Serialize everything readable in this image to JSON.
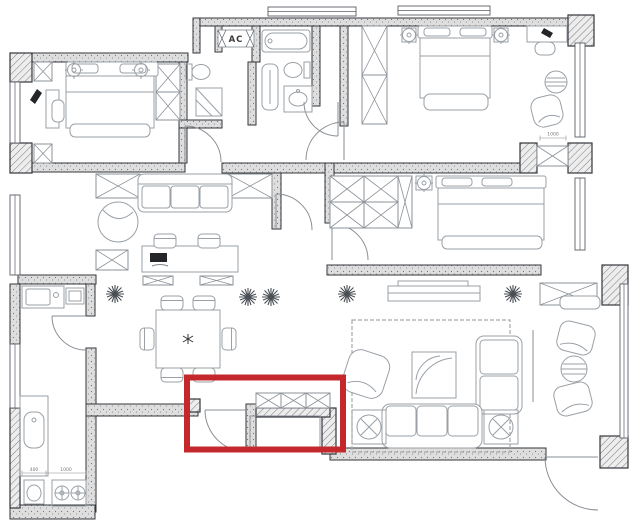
{
  "title": "Apartment floor plan drawing with red highlight annotation",
  "colors": {
    "background": "#ffffff",
    "walls": "#33363b",
    "furniture_lines": "#9aa0a6",
    "text": "#777777",
    "highlight": "#c4282d"
  },
  "labels": {
    "ac": "AC",
    "dim_400": "400",
    "dim_1000": "1000",
    "dim_master": "1000"
  },
  "highlight": {
    "color": "#c4282d",
    "note": "red-box-around-passage-door-and-built-in-cabinet"
  },
  "rooms": {
    "bedroom_top_left": [
      "double-bed",
      "bedside-lamps",
      "wardrobe",
      "desk",
      "chair",
      "window"
    ],
    "bathroom_left": [
      "toilet",
      "corner-shower"
    ],
    "ac_closet": [
      "ac-unit"
    ],
    "bathroom_right": [
      "bathtub",
      "shower-column",
      "toilet",
      "vanity-sink"
    ],
    "master_bedroom": [
      "double-bed",
      "bedside-lamps",
      "wardrobe",
      "desk",
      "chair",
      "round-table",
      "armchair",
      "window",
      "closet"
    ],
    "bedroom_right": [
      "double-bed",
      "bedside-lamp",
      "wardrobe",
      "window"
    ],
    "study_room": [
      "sofa",
      "armchair",
      "work-table",
      "chairs",
      "laptop",
      "cabinets",
      "window"
    ],
    "dining_room": [
      "dining-table",
      "chairs",
      "plants"
    ],
    "kitchen": [
      "sink",
      "counter",
      "stove",
      "utility-basin",
      "window"
    ],
    "living_room": [
      "three-seat-sofa",
      "loveseat",
      "armchair",
      "coffee-table",
      "side-tables",
      "tv-console",
      "rug",
      "plants"
    ],
    "balcony": [
      "chairs",
      "round-table"
    ],
    "entry": [
      "entry-door"
    ]
  }
}
